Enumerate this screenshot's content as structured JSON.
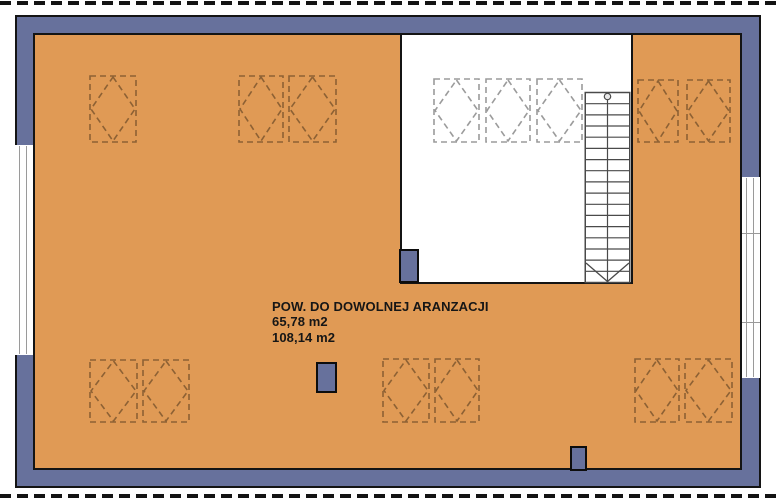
{
  "labels": {
    "area_title": "POW. DO DOWOLNEJ ARANZACJI",
    "area_value_1": "65,78 m2",
    "area_value_2": "108,14 m2"
  },
  "colors": {
    "floor": "#e09a55",
    "wall": "#67719c",
    "outline": "#141414",
    "dash_on_floor": "#8d6134",
    "dash_on_white": "#9b9b9b",
    "stair_line": "#4a4a4a",
    "window_line": "#9a9a9a"
  },
  "skylights": [
    {
      "x": 89,
      "y": 75,
      "w": 48,
      "h": 68,
      "surface": "floor"
    },
    {
      "x": 238,
      "y": 75,
      "w": 46,
      "h": 68,
      "surface": "floor"
    },
    {
      "x": 288,
      "y": 75,
      "w": 49,
      "h": 68,
      "surface": "floor"
    },
    {
      "x": 433,
      "y": 78,
      "w": 47,
      "h": 65,
      "surface": "white"
    },
    {
      "x": 485,
      "y": 78,
      "w": 46,
      "h": 65,
      "surface": "white"
    },
    {
      "x": 536,
      "y": 78,
      "w": 47,
      "h": 65,
      "surface": "white"
    },
    {
      "x": 637,
      "y": 79,
      "w": 42,
      "h": 64,
      "surface": "floor"
    },
    {
      "x": 686,
      "y": 79,
      "w": 45,
      "h": 64,
      "surface": "floor"
    },
    {
      "x": 89,
      "y": 359,
      "w": 49,
      "h": 64,
      "surface": "floor"
    },
    {
      "x": 142,
      "y": 359,
      "w": 48,
      "h": 64,
      "surface": "floor"
    },
    {
      "x": 382,
      "y": 358,
      "w": 48,
      "h": 65,
      "surface": "floor"
    },
    {
      "x": 434,
      "y": 358,
      "w": 46,
      "h": 65,
      "surface": "floor"
    },
    {
      "x": 634,
      "y": 358,
      "w": 46,
      "h": 65,
      "surface": "floor"
    },
    {
      "x": 684,
      "y": 358,
      "w": 49,
      "h": 65,
      "surface": "floor"
    }
  ],
  "chimneys": [
    {
      "x": 399,
      "y": 249,
      "w": 20,
      "h": 34
    },
    {
      "x": 316,
      "y": 362,
      "w": 21,
      "h": 31
    },
    {
      "x": 570,
      "y": 446,
      "w": 17,
      "h": 25
    }
  ],
  "windows": [
    {
      "x": 15,
      "y": 145,
      "w": 18,
      "h": 210,
      "dividers": []
    },
    {
      "x": 742,
      "y": 177,
      "w": 18,
      "h": 201,
      "dividers": [
        56,
        145
      ]
    }
  ],
  "stairs": {
    "treads": 17
  }
}
